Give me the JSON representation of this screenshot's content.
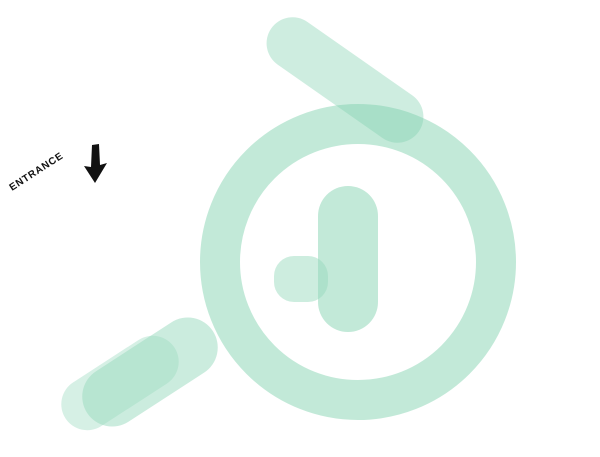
{
  "entrance": {
    "label": "ENTRANCE"
  },
  "palette": {
    "bg": "#ffffff",
    "text": "#111111",
    "slabTop": "#fcfcfb",
    "slabSideL": "#e2e1df",
    "slabSideR": "#d2d1cf",
    "wallTop": "#fefefe",
    "wallFace": "#f7f6f4",
    "wallShade": "#e7e7ea",
    "floorLiving": "#eae0cf",
    "floorKitchen": "#f1ebe2",
    "wood": "#d9a873",
    "woodDark": "#bf8c55",
    "tileCream": "#e8dccb",
    "tileBrown": "#8e7164",
    "bathFloor": "#6fb79c",
    "bathFloorDark": "#4f9e83",
    "utilFloor": "#a0a09e",
    "mint": "#abdec7",
    "mintSide": "#8fcbb0",
    "mintLight": "#c9eedb",
    "glass": "rgba(190,228,212,0.55)",
    "railMetal": "#c3cdc8",
    "railGlass": "rgba(216,236,229,0.42)",
    "greenDark": "#1e5a44",
    "greenDarker": "#153f30",
    "greenTop": "#236349",
    "outdoor": "#3f8f58",
    "outdoorTop": "#4da266",
    "outdoorDark": "#2f7344",
    "bedGreen": "#a8c489",
    "bedGreenSide": "#92b172",
    "stripeDark": "#202020",
    "stripeLight": "#f3f3f1",
    "counter": "#2b2b2b",
    "warm": "#ffc466",
    "plant": "#3c7a4b",
    "plantDark": "#2a5c38",
    "tvFrame": "#101418",
    "tvScreen": "#0d2d3f",
    "tvCyan": "#39b9e8",
    "tvMagenta": "#b95ad6",
    "wm1": "#7fd0ae",
    "wm2": "#97d9bd",
    "shadow": "rgba(0,0,0,0.08)"
  }
}
